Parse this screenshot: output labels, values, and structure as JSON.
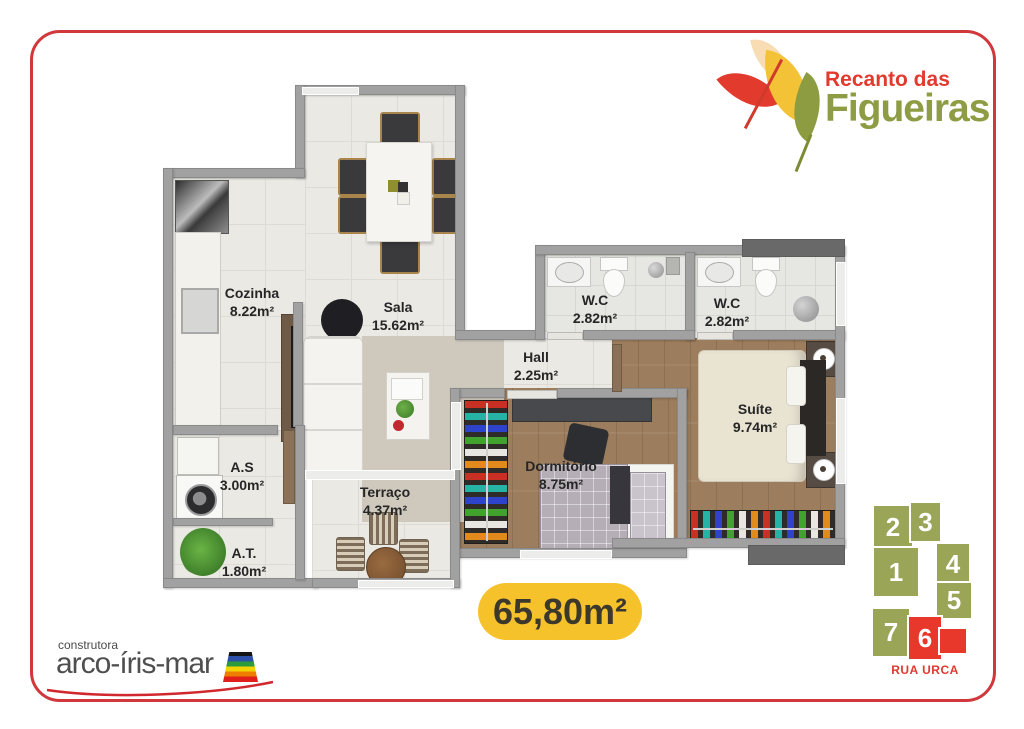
{
  "brand": {
    "line1": "Recanto das",
    "line2": "Figueiras"
  },
  "rooms": {
    "cozinha": {
      "name": "Cozinha",
      "area": "8.22m²"
    },
    "sala": {
      "name": "Sala",
      "area": "15.62m²"
    },
    "wc1": {
      "name": "W.C",
      "area": "2.82m²"
    },
    "wc2": {
      "name": "W.C",
      "area": "2.82m²"
    },
    "hall": {
      "name": "Hall",
      "area": "2.25m²"
    },
    "suite": {
      "name": "Suíte",
      "area": "9.74m²"
    },
    "dormitorio": {
      "name": "Dormitório",
      "area": "8.75m²"
    },
    "area_servico": {
      "name": "A.S",
      "area": "3.00m²"
    },
    "terraco": {
      "name": "Terraço",
      "area": "4.37m²"
    },
    "area_tecnica": {
      "name": "A.T.",
      "area": "1.80m²"
    }
  },
  "total_area": "65,80m²",
  "builder": {
    "tagline": "construtora",
    "name": "arco-íris-mar"
  },
  "keyplan": {
    "units": [
      "1",
      "2",
      "3",
      "4",
      "5",
      "6",
      "7"
    ],
    "highlighted_unit": "6",
    "street": "RUA URCA"
  },
  "colors": {
    "frame_red": "#d0383c",
    "brand_red": "#e23a2f",
    "brand_green": "#8e9c44",
    "badge_yellow": "#f6c22c",
    "keyplan_olive": "#9aa558",
    "keyplan_red": "#e8382b"
  }
}
